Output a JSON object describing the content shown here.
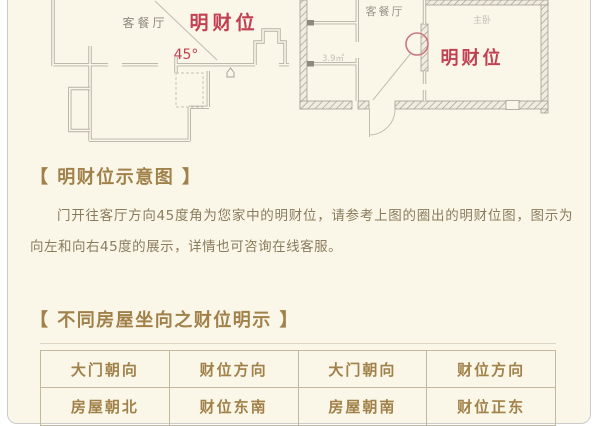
{
  "colors": {
    "card_bg": "#fbf7e8",
    "accent_gold": "#a1814a",
    "body_text": "#8a7b5c",
    "highlight_red": "#c24052",
    "wall_gray": "#b6b0a5",
    "table_border": "#c3b99e"
  },
  "plan_left": {
    "room": "客餐厅",
    "wealth": "明财位",
    "angle": "45°"
  },
  "plan_right": {
    "room": "客餐厅",
    "wealth": "明财位",
    "bedroom": "主卧",
    "area": "3.9㎡"
  },
  "section_diagram": {
    "heading": "【 明财位示意图 】",
    "body": "门开往客厅方向45度角为您家中的明财位，请参考上图的圈出的明财位图，图示为向左和向右45度的展示，详情也可咨询在线客服。"
  },
  "section_table": {
    "heading": "【 不同房屋坐向之财位明示 】"
  },
  "table": {
    "headers": [
      "大门朝向",
      "财位方向",
      "大门朝向",
      "财位方向"
    ],
    "rows": [
      [
        "房屋朝北",
        "财位东南",
        "房屋朝南",
        "财位正东"
      ]
    ]
  }
}
